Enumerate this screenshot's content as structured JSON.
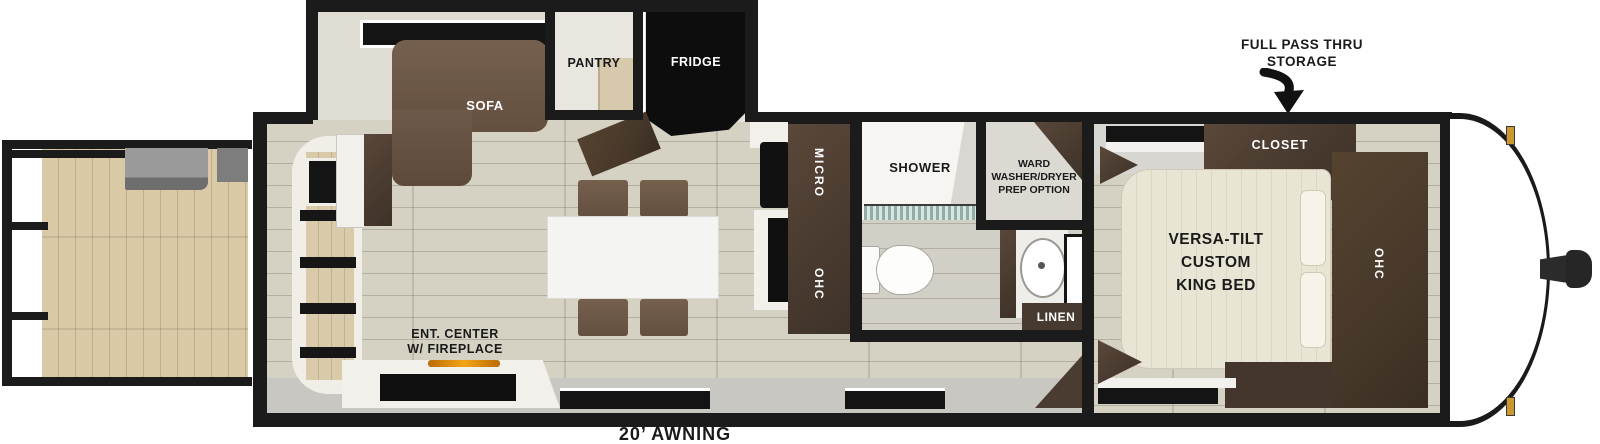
{
  "diagram": {
    "type": "rv-travel-trailer-floorplan",
    "callouts": {
      "full_pass_thru_line1": "FULL PASS THRU",
      "full_pass_thru_line2": "STORAGE",
      "awning": "20’ AWNING"
    },
    "slideout": {
      "sofa": "SOFA",
      "pantry": "PANTRY",
      "fridge": "FRIDGE"
    },
    "kitchen": {
      "micro": "MICRO",
      "ohc": "OHC"
    },
    "bath": {
      "shower": "SHOWER",
      "ward_line1": "WARD",
      "ward_line2": "WASHER/DRYER",
      "ward_line3": "PREP OPTION",
      "linen": "LINEN"
    },
    "bedroom": {
      "closet": "CLOSET",
      "bed_line1": "VERSA-TILT",
      "bed_line2": "CUSTOM",
      "bed_line3": "KING BED",
      "ohc": "OHC"
    },
    "living": {
      "ent_line1": "ENT. CENTER",
      "ent_line2": "W/ FIREPLACE"
    },
    "colors": {
      "wall": "#1b1b1b",
      "floor": "#d5d1c3",
      "deck": "#dac9a7",
      "cabinet_dark": "#4a3b30",
      "sofa_brown": "#6b574a",
      "bed_cream": "#e9e5d4",
      "walkway_gray": "#c9c7c2",
      "marker_light_gold": "#c9982f",
      "fireplace_orange": "#e8930c",
      "shower_floor_teal": "#b9d6d0"
    }
  }
}
